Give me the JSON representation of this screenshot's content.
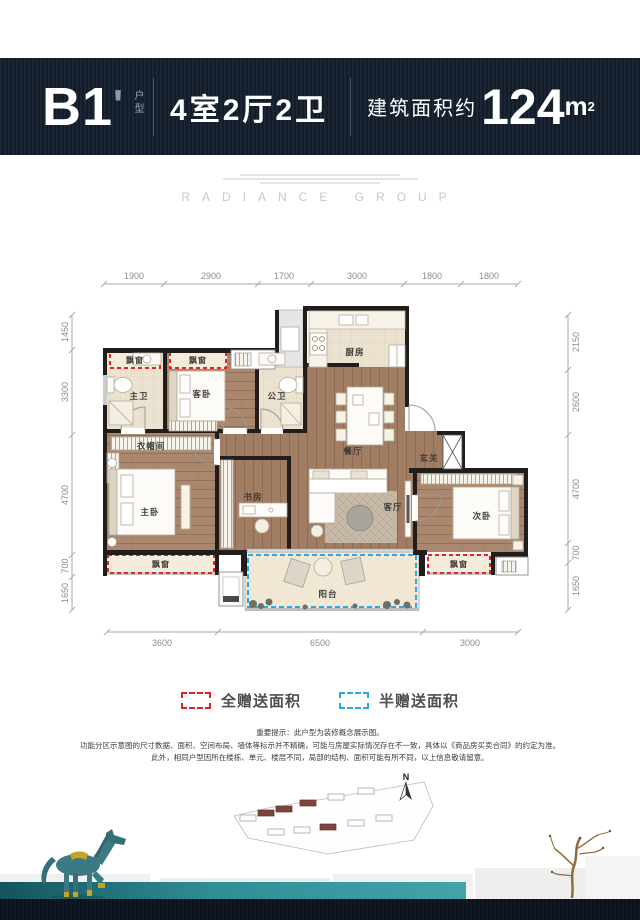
{
  "header": {
    "code": "B1",
    "mark": "'",
    "code_suffix": "户型",
    "layout": "4室2厅2卫",
    "area_label": "建筑面积约",
    "area_value": "124",
    "area_unit": "m",
    "area_sup": "2"
  },
  "watermark": {
    "brand": "RADIANCE GROUP"
  },
  "plan": {
    "dims_top": [
      "1900",
      "2900",
      "1700",
      "3000",
      "1800",
      "1800"
    ],
    "dims_left": [
      "1450",
      "3300",
      "4700",
      "700",
      "1650"
    ],
    "dims_right": [
      "2150",
      "2600",
      "4700",
      "700",
      "1650"
    ],
    "dims_bottom": [
      "3600",
      "6500",
      "3000"
    ],
    "rooms": {
      "master_bath": "主卫",
      "guest_bedroom": "客卧",
      "public_bath": "公卫",
      "kitchen": "厨房",
      "dining": "餐厅",
      "foyer": "玄关",
      "cloakroom": "衣帽间",
      "master_bedroom": "主卧",
      "study": "书房",
      "living": "客厅",
      "second_bedroom": "次卧",
      "balcony": "阳台"
    },
    "bay_window": "飘窗"
  },
  "legend": {
    "full_gift": "全赠送面积",
    "half_gift": "半赠送面积",
    "red": "#e62129",
    "blue": "#2ba7e8"
  },
  "notice": {
    "line1": "重要提示：此户型为装修概念展示图。",
    "line2": "功能分区示意图的尺寸数据、面积、空间布局、墙体等标示并不精确，可能与房屋实际情况存在不一致，具体以《商品房买卖合同》的约定为准。",
    "line3": "此外，相同户型因所在楼栋、单元、楼层不同，局部的结构、面积可能有所不同，以上信息敬请留意。"
  },
  "siteplan": {
    "compass": "N"
  }
}
